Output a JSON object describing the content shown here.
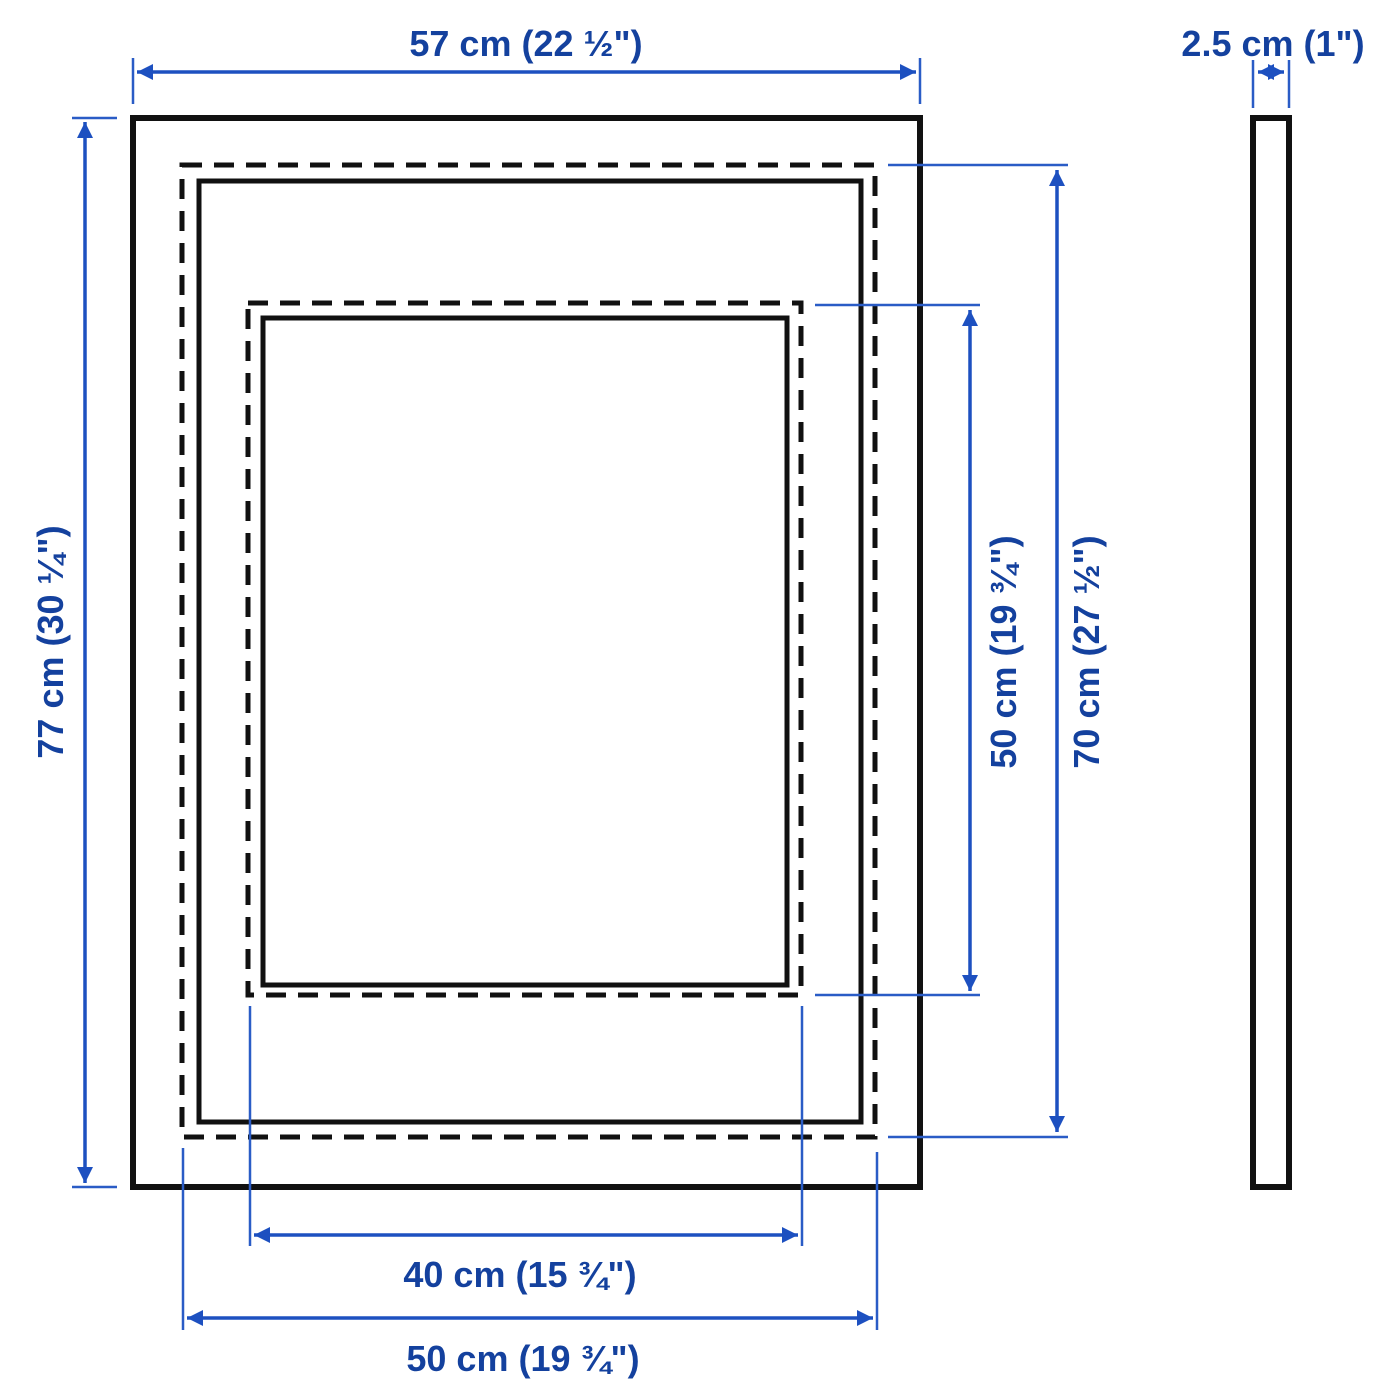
{
  "diagram": {
    "kind": "product-dimension-drawing",
    "views": {
      "front": "frame front view",
      "side": "frame side profile"
    },
    "colors": {
      "outline_black": "#111111",
      "dimension_blue": "#1d50c0",
      "text_blue": "#14419e",
      "background": "#ffffff"
    },
    "dimensions": {
      "frame_width": "57 cm (22 ½\")",
      "frame_depth": "2.5 cm (1\")",
      "frame_height": "77 cm (30 ¼\")",
      "picture_height": "50 cm (19 ¾\")",
      "back_height": "70 cm (27 ½\")",
      "mat_opening_width": "40 cm (15 ¾\")",
      "picture_width": "50 cm (19 ¾\")"
    }
  }
}
